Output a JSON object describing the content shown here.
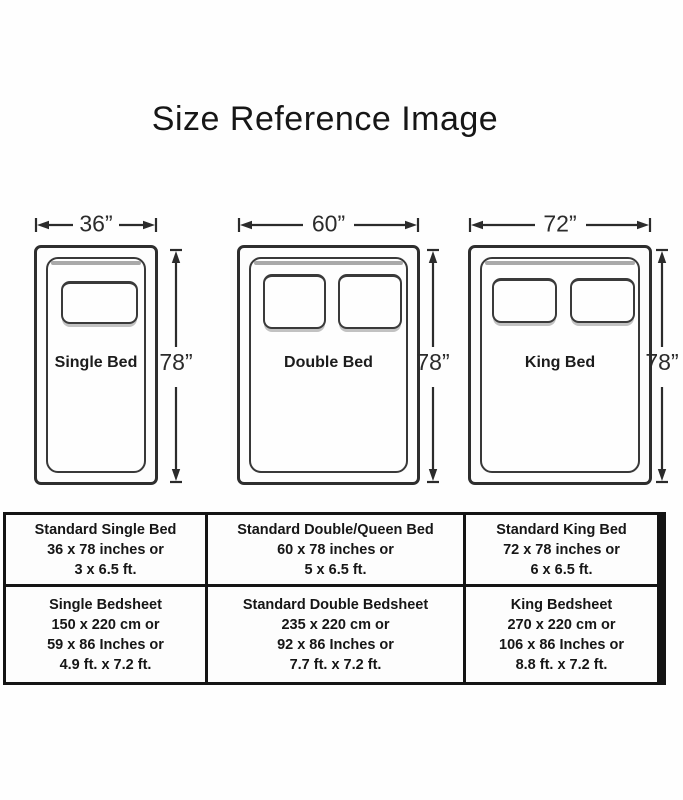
{
  "title": "Size Reference Image",
  "beds": [
    {
      "name": "Single Bed",
      "width_label": "36”",
      "height_label": "78”",
      "pillow_count": 1
    },
    {
      "name": "Double Bed",
      "width_label": "60”",
      "height_label": "78”",
      "pillow_count": 2
    },
    {
      "name": "King Bed",
      "width_label": "72”",
      "height_label": "78”",
      "pillow_count": 2
    }
  ],
  "table": {
    "rows": [
      {
        "cells": [
          {
            "lines": [
              "Standard Single Bed",
              "36 x 78 inches or",
              "3 x 6.5 ft."
            ]
          },
          {
            "lines": [
              "Standard Double/Queen Bed",
              "60 x 78 inches or",
              "5 x 6.5 ft."
            ]
          },
          {
            "lines": [
              "Standard King Bed",
              "72 x 78 inches or",
              "6 x 6.5 ft."
            ]
          }
        ]
      },
      {
        "cells": [
          {
            "lines": [
              "Single Bedsheet",
              "150 x 220 cm or",
              "59 x 86 Inches or",
              "4.9 ft. x 7.2 ft."
            ]
          },
          {
            "lines": [
              "Standard Double Bedsheet",
              "235 x 220 cm or",
              "92 x 86 Inches or",
              "7.7 ft. x 7.2 ft."
            ]
          },
          {
            "lines": [
              "King Bedsheet",
              "270 x 220 cm or",
              "106 x 86 Inches or",
              "8.8 ft. x 7.2 ft."
            ]
          }
        ]
      }
    ]
  },
  "colors": {
    "line": "#2b2b2b",
    "table_border": "#141414",
    "text": "#161616",
    "shadow": "#a9a9a9"
  }
}
